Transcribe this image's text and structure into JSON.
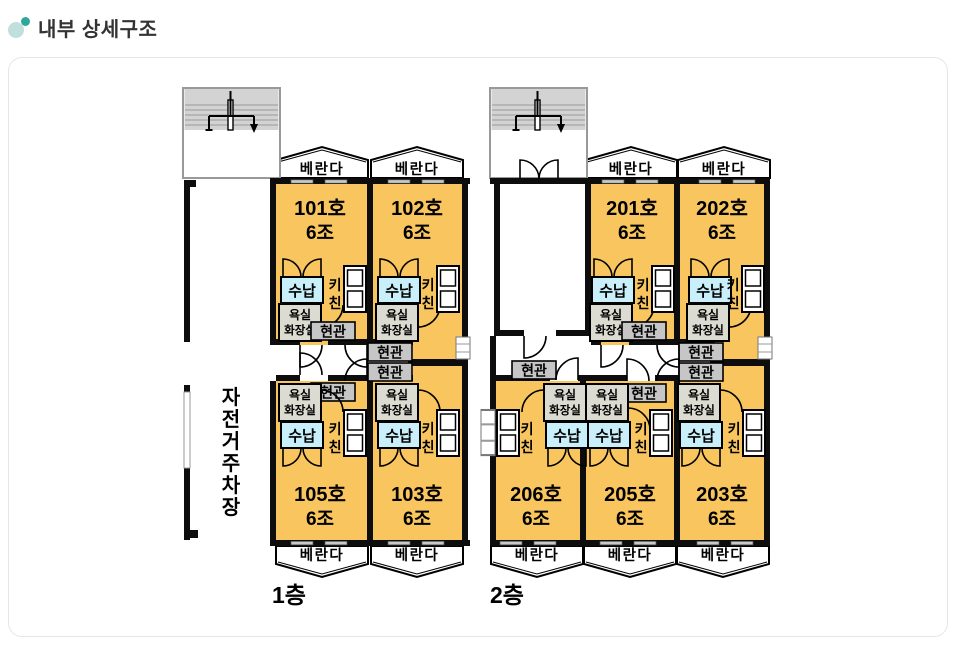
{
  "header": {
    "title": "내부 상세구조"
  },
  "floors": {
    "floor1": "1층",
    "floor2": "2층"
  },
  "labels": {
    "veranda": "베란다",
    "storage": "수납",
    "kitchen_char1": "키",
    "kitchen_char2": "친",
    "bath_line1": "욕실",
    "bath_line2": "화장실",
    "entrance": "현관"
  },
  "parking": {
    "char0": "자",
    "char1": "전",
    "char2": "거",
    "char3": "주",
    "char4": "차",
    "char5": "장"
  },
  "rooms": {
    "r101": {
      "no": "101호",
      "size": "6조"
    },
    "r102": {
      "no": "102호",
      "size": "6조"
    },
    "r105": {
      "no": "105호",
      "size": "6조"
    },
    "r103": {
      "no": "103호",
      "size": "6조"
    },
    "r201": {
      "no": "201호",
      "size": "6조"
    },
    "r202": {
      "no": "202호",
      "size": "6조"
    },
    "r206": {
      "no": "206호",
      "size": "6조"
    },
    "r205": {
      "no": "205호",
      "size": "6조"
    },
    "r203": {
      "no": "203호",
      "size": "6조"
    }
  },
  "colors": {
    "accent_teal": "#2fa79c",
    "accent_teal_light": "#bfe0dc",
    "room_fill": "#F8C55E",
    "storage_fill": "#C8EFFA",
    "bath_fill": "#DBDBD1",
    "entrance_fill": "#C6C6C6",
    "stair_fill": "#D3D3D3",
    "wall": "#0D0D0D"
  }
}
